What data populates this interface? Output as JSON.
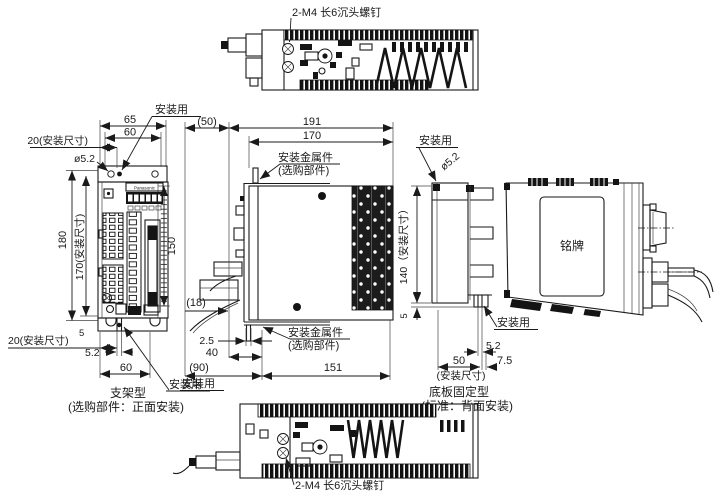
{
  "doc": {
    "type": "dimension-drawing",
    "top_note": "2-M4 长6沉头螺钉",
    "bottom_note": "2-M4 长6沉头螺钉"
  },
  "front": {
    "labels": {
      "mount_top": "安装用",
      "mount_bottom": "安装用",
      "brand": "Panasonic"
    },
    "dims": {
      "w65": "65",
      "w60_top": "60",
      "off20_top": "20(安装尺寸)",
      "hole_dia": "ø5.2",
      "h180": "180",
      "h170": "170(安装尺寸)",
      "h150": "150",
      "foot5": "5",
      "off20_bot": "20(安装尺寸)",
      "slot52": "5.2",
      "w60_bot": "60"
    },
    "caption": {
      "line1": "支架型",
      "line2": "(选购部件：正面安装)"
    }
  },
  "side": {
    "labels": {
      "fitting_top1": "安装金属件",
      "fitting_top2": "(选购部件)",
      "fitting_bot1": "安装金属件",
      "fitting_bot2": "(选购部件)",
      "mount": "安装用"
    },
    "dims": {
      "d50": "(50)",
      "d191": "191",
      "d170": "170",
      "d18": "(18)",
      "d25": "2.5",
      "d40": "40",
      "d90": "(90)",
      "d151": "151"
    }
  },
  "rear": {
    "labels": {
      "mount_top": "安装用",
      "mount_bottom": "安装用",
      "nameplate": "铭牌"
    },
    "dims": {
      "hole_dia": "ø5.2",
      "h140": "140（安装尺寸）",
      "foot5": "5",
      "slot52": "5.2",
      "w50": "50",
      "w75": "7.5",
      "note": "(安装尺寸)"
    },
    "caption": {
      "line1": "底板固定型",
      "line2": "(标准：背面安装)"
    }
  }
}
